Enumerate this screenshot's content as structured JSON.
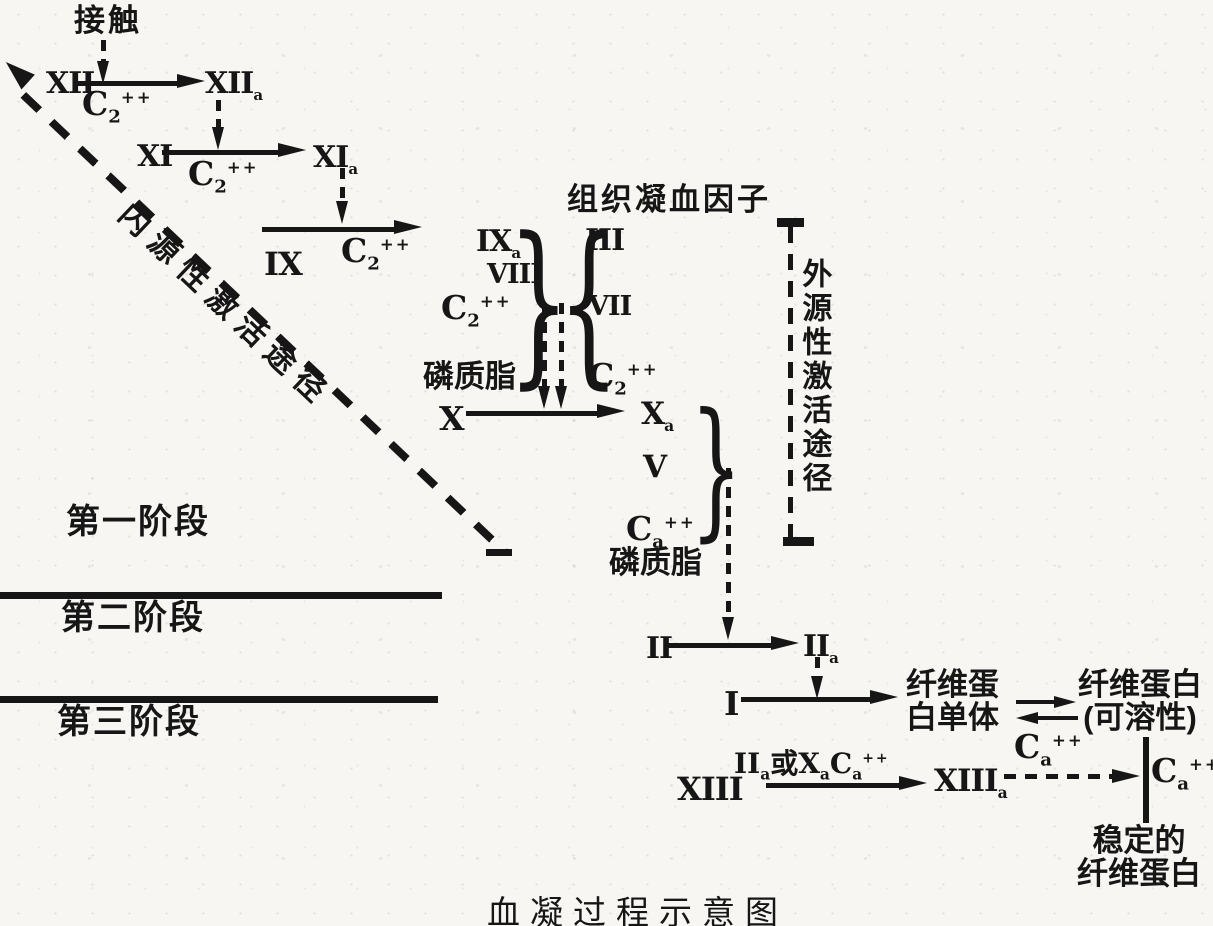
{
  "title": "血凝过程示意图",
  "labels": {
    "contact": "接触",
    "tissue_factor": "组织凝血因子",
    "intrinsic_pathway": "内源性激活途径",
    "extrinsic_pathway": "外源性激活途径",
    "phospholipid_upper": "磷质脂",
    "phospholipid_lower": "磷质脂"
  },
  "stages": {
    "s1": "第一阶段",
    "s2": "第二阶段",
    "s3": "第三阶段"
  },
  "factors": {
    "f12": "XII",
    "f12a": {
      "base": "XII",
      "sub": "a"
    },
    "f11": "XI",
    "f11a": {
      "base": "XI",
      "sub": "a"
    },
    "f9": "IX",
    "f9a": {
      "base": "IX",
      "sub": "a"
    },
    "f8": "VIII",
    "f3": "III",
    "f7": "VII",
    "f10": "X",
    "f10a": {
      "base": "X",
      "sub": "a"
    },
    "f5": "V",
    "f2": "II",
    "f2a": {
      "base": "II",
      "sub": "a"
    },
    "f1": "I",
    "f13": "XIII",
    "f13a": {
      "base": "XIII",
      "sub": "a"
    }
  },
  "calcium": {
    "c12": {
      "base": "C",
      "sub": "2",
      "sup": "++"
    },
    "c11": {
      "base": "C",
      "sub": "2",
      "sup": "++"
    },
    "c9": {
      "base": "C",
      "sub": "2",
      "sup": "++"
    },
    "c_intrinsic_complex": {
      "base": "C",
      "sub": "2",
      "sup": "++"
    },
    "c_extrinsic_complex": {
      "base": "C",
      "sub": "2",
      "sup": "++"
    },
    "c_prothrombinase": {
      "base": "C",
      "sub": "a",
      "sup": "++"
    },
    "c_polymerization": {
      "base": "C",
      "sub": "a",
      "sup": "++"
    },
    "c_stabilization": {
      "base": "C",
      "sub": "a",
      "sup": "++"
    }
  },
  "xiii_activators": {
    "p1": "II",
    "s1": "a",
    "p2": "或X",
    "s2": "a",
    "p3": "C",
    "s3": "a",
    "sup": "++"
  },
  "products": {
    "fibrin_monomer_line1": "纤维蛋",
    "fibrin_monomer_line2": "白单体",
    "fibrin_soluble_line1": "纤维蛋白",
    "fibrin_soluble_line2": "(可溶性)",
    "stable_fibrin_line1": "稳定的",
    "stable_fibrin_line2": "纤维蛋白"
  },
  "colors": {
    "ink": "#161616",
    "paper": "#f7f6f2"
  }
}
